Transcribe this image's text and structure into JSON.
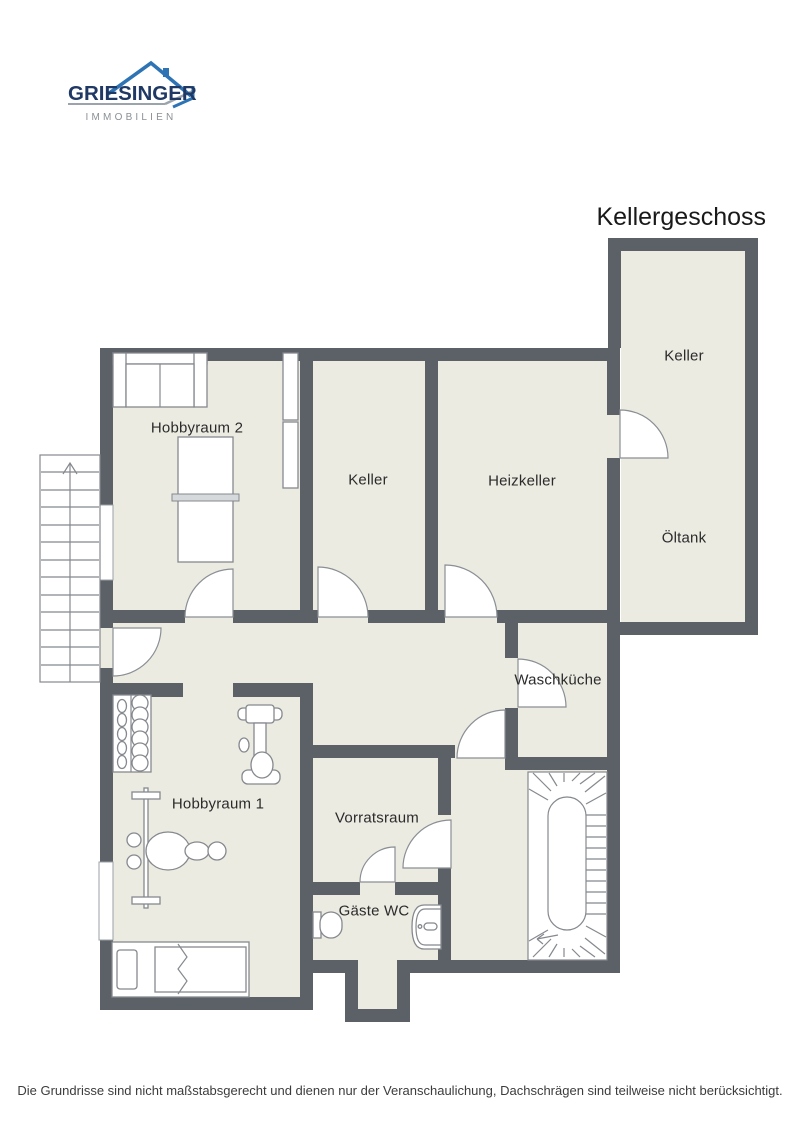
{
  "logo": {
    "brand": "GRIESINGER",
    "tagline": "IMMOBILIEN"
  },
  "title": "Kellergeschoss",
  "rooms": {
    "hobbyraum2": "Hobbyraum 2",
    "keller_mitte": "Keller",
    "heizkeller": "Heizkeller",
    "keller_oben": "Keller",
    "oeltank": "Öltank",
    "waschkueche": "Waschküche",
    "hobbyraum1": "Hobbyraum 1",
    "vorratsraum": "Vorratsraum",
    "gaeste_wc": "Gäste WC"
  },
  "footer": {
    "disclaimer": "Die Grundrisse sind nicht maßstabsgerecht und dienen nur der Veranschaulichung, Dachschrägen sind teilweise nicht berücksichtigt."
  },
  "colors": {
    "wall": "#5C6167",
    "floor": "#ECEBE2",
    "logo_navy": "#1F3864",
    "logo_blue": "#2E74B5",
    "logo_gray": "#8A9096"
  }
}
